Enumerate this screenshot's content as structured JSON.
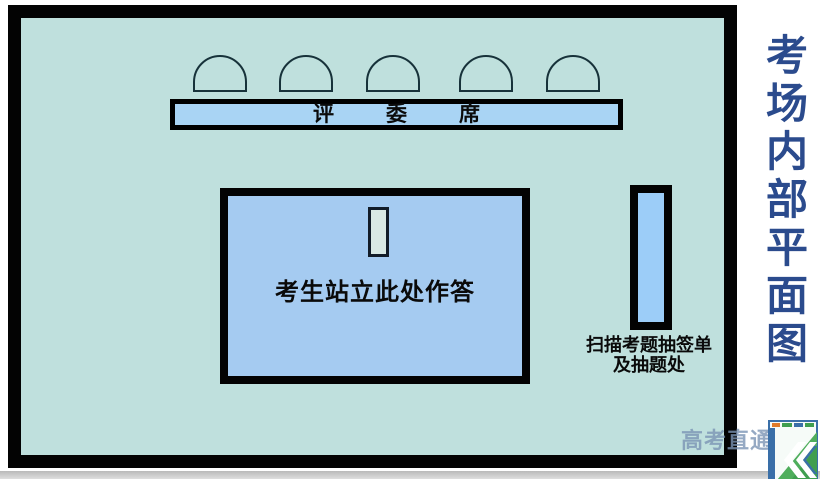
{
  "sidebar": {
    "title": "考场内部平面图",
    "title_chars": [
      "考",
      "场",
      "内",
      "部",
      "平",
      "面",
      "图"
    ]
  },
  "room": {
    "judges_bench": {
      "chars": [
        "评",
        "委",
        "席"
      ],
      "label": "评委席",
      "chair_count": 5
    },
    "stage": {
      "label": "考生站立此处作答"
    },
    "scan_area": {
      "line1": "扫描考题抽签单",
      "line2": "及抽题处"
    }
  },
  "watermark": {
    "text": "高考直通车"
  },
  "colors": {
    "room_fill": "#bfe0dd",
    "room_border": "#030303",
    "bench_fill": "#a9d4f4",
    "stage_fill": "#a5cbf1",
    "scan_table_fill": "#9ccdf8",
    "standing_marker_fill": "#d9e9e4",
    "title_blue": "#2b4b8d",
    "watermark_blue_gray": "#7a94b4",
    "logo_green": "#3f9e4f",
    "logo_blue": "#3a6fa8",
    "bottom_strip_gray": "#c6c6c6"
  }
}
